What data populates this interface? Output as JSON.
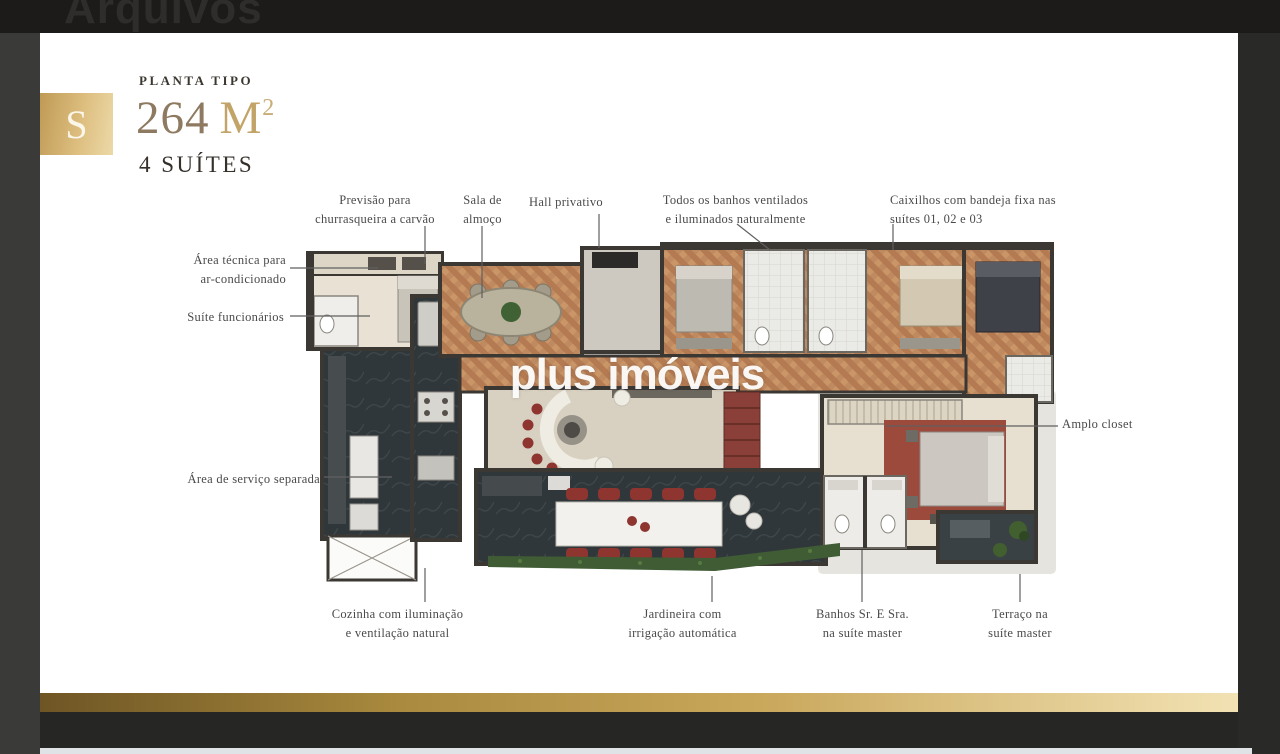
{
  "header": {
    "title": "Arquivos"
  },
  "plan_card": {
    "badge_letter": "S",
    "eyebrow": "PLANTA TIPO",
    "area_number": "264",
    "area_unit": "M",
    "area_sup": "2",
    "suites_line": "4 SUÍTES",
    "watermark": "plus imóveis"
  },
  "callouts": {
    "previsao": [
      "Previsão para",
      "churrasqueira a carvão"
    ],
    "sala_almoco": [
      "Sala de",
      "almoço"
    ],
    "hall": [
      "Hall privativo"
    ],
    "banhos_ventilados": [
      "Todos os banhos ventilados",
      "e iluminados naturalmente"
    ],
    "caixilhos": [
      "Caixilhos com bandeja fixa nas",
      "suítes 01, 02 e 03"
    ],
    "area_tecnica": [
      "Área técnica para",
      "ar-condicionado"
    ],
    "suite_funcionarios": [
      "Suíte funcionários"
    ],
    "area_servico": [
      "Área de serviço separada"
    ],
    "amplo_closet": [
      "Amplo closet"
    ],
    "cozinha": [
      "Cozinha com iluminação",
      "e ventilação natural"
    ],
    "jardineira": [
      "Jardineira com",
      "irrigação automática"
    ],
    "banhos_master": [
      "Banhos Sr. E Sra.",
      "na suíte master"
    ],
    "terraco": [
      "Terraço na",
      "suíte master"
    ]
  },
  "colors": {
    "gold_dark": "#6e5524",
    "gold_light": "#f2e2b4",
    "badge_gold": "#d3b273",
    "card_bg": "#ffffff",
    "page_bg": "#262625",
    "label_text": "#4a4a4a",
    "wall": "#3b3733",
    "wood_floor": "#c08a60",
    "beige_floor": "#e9e2d4",
    "dark_floor": "#30373a",
    "bath_floor": "#eaeae6",
    "rug_red": "#9c4a3c",
    "accent_red": "#8e3530",
    "plant_green": "#3f5c34"
  }
}
